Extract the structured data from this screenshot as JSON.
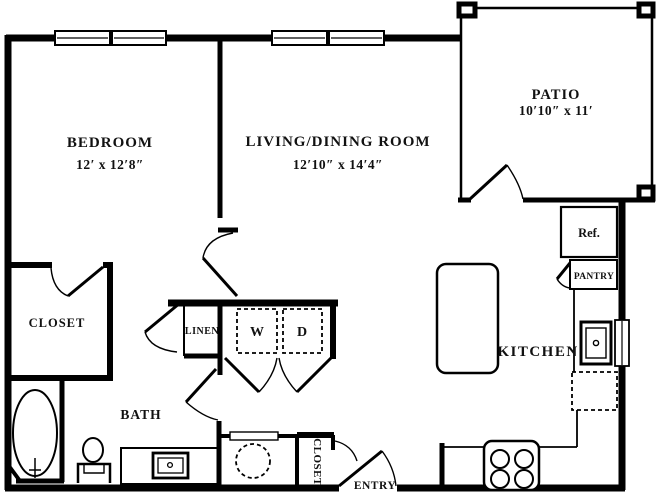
{
  "canvas": {
    "width": 658,
    "height": 492,
    "background": "#ffffff",
    "line_color": "#000000"
  },
  "rooms": {
    "bedroom": {
      "label": "BEDROOM",
      "dims": "12′ x 12′8″"
    },
    "living_dining": {
      "label": "LIVING/DINING ROOM",
      "dims": "12′10″ x 14′4″"
    },
    "patio": {
      "label": "PATIO",
      "dims": "10′10″ x 11′"
    },
    "bedroom_closet": {
      "label": "CLOSET"
    },
    "bath": {
      "label": "BATH"
    },
    "kitchen": {
      "label": "KITCHEN"
    },
    "linen": {
      "label": "LINEN"
    },
    "pantry": {
      "label": "PANTRY"
    },
    "entry_closet": {
      "label": "CLOSET"
    },
    "entry": {
      "label": "ENTRY"
    }
  },
  "fixtures": {
    "washer": "W",
    "dryer": "D",
    "refrigerator": "Ref."
  }
}
